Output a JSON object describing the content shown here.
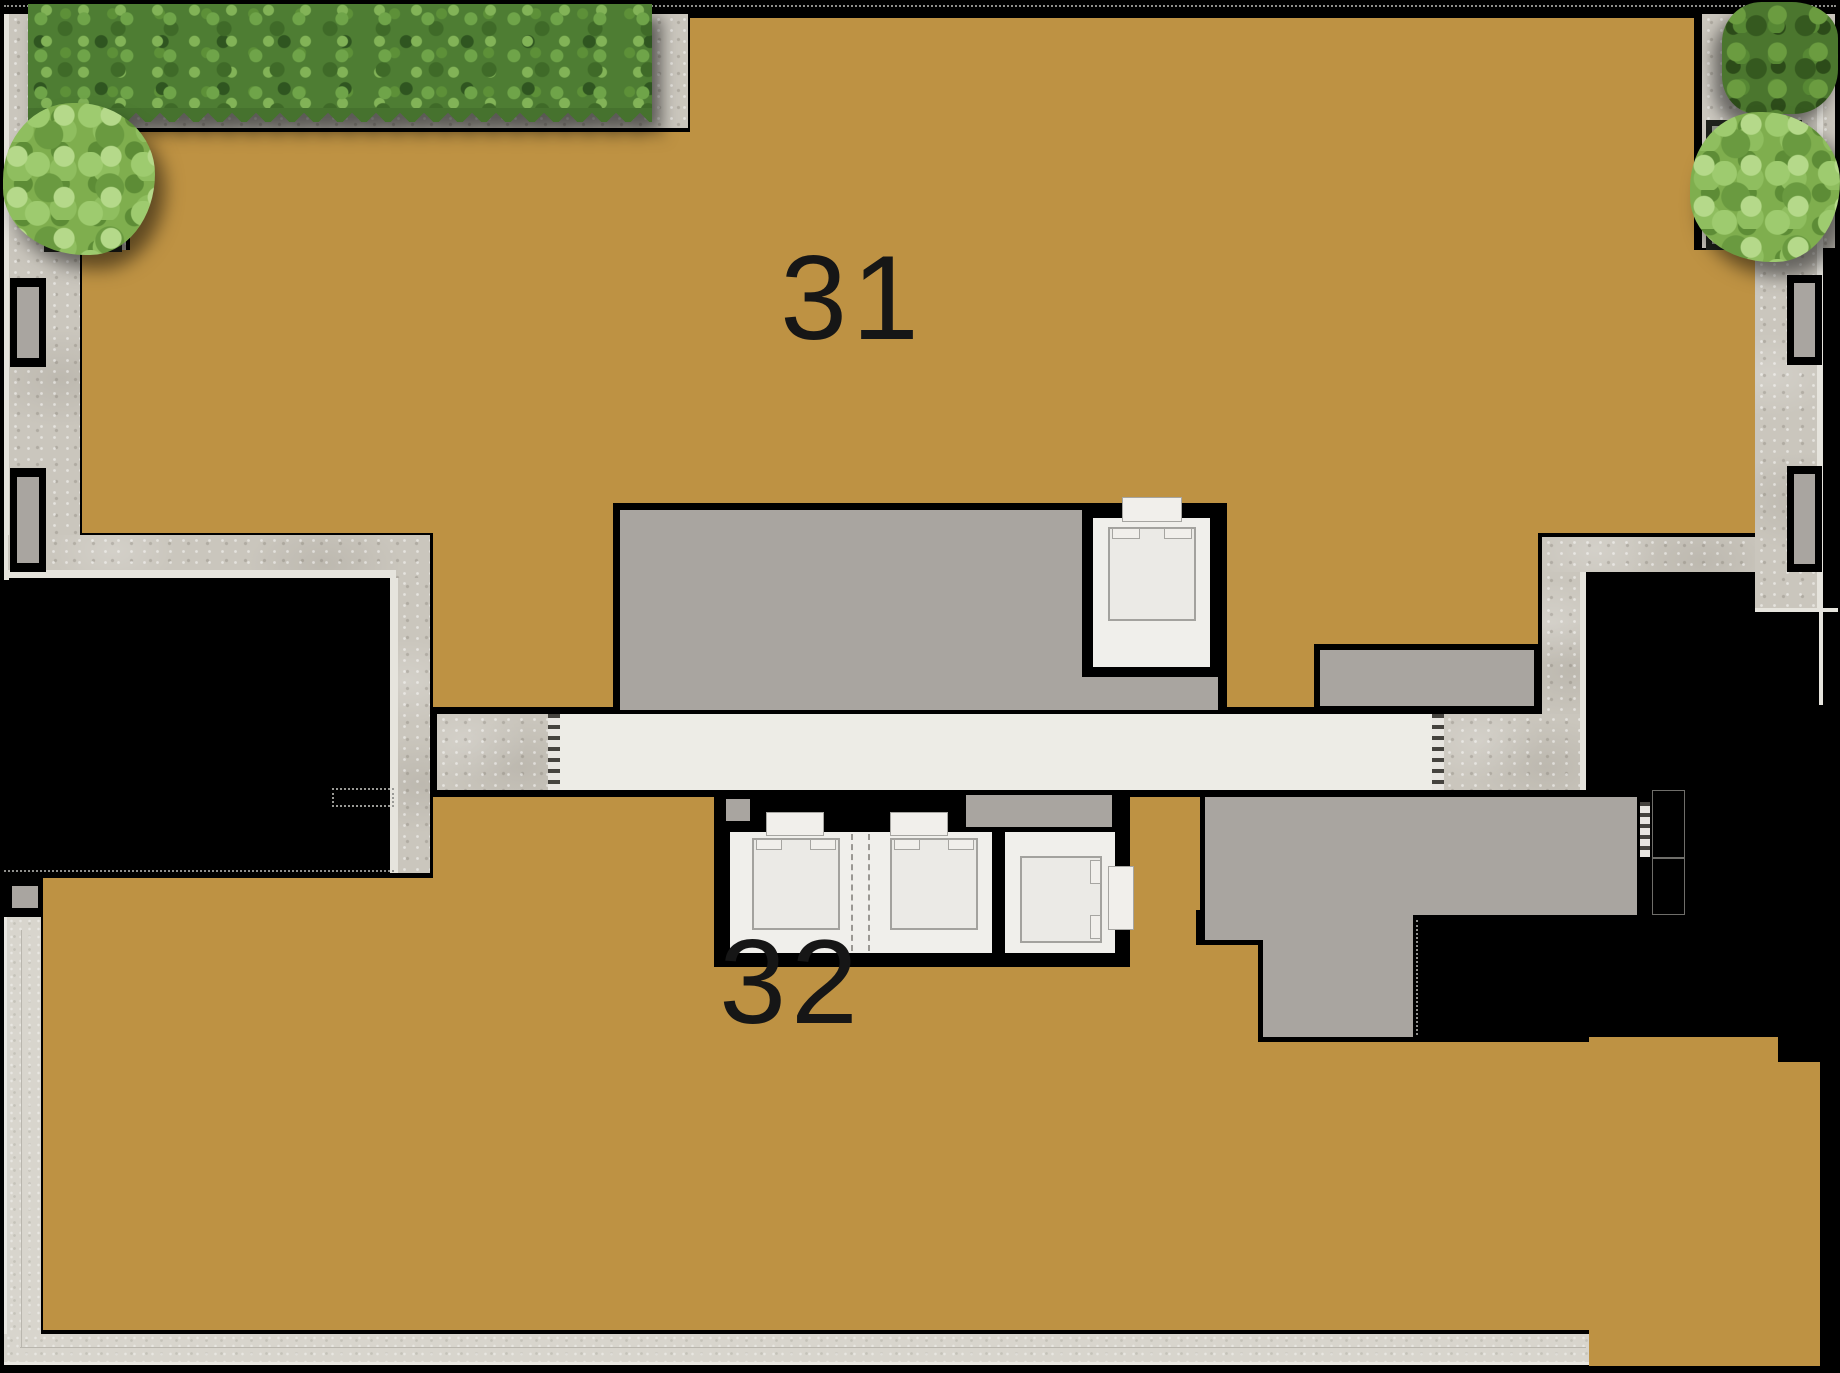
{
  "plan": {
    "type": "residential-floor-plan",
    "units": [
      {
        "name": "unit-31",
        "label": "31"
      },
      {
        "name": "unit-32",
        "label": "32"
      }
    ]
  },
  "colors": {
    "background": "#000000",
    "unit_fill": "#be9243",
    "core_gray": "#a9a5a0",
    "corridor": "#edece6",
    "concrete": "#cac6bd",
    "walkway": "#d8d5cd",
    "elevator_white": "#f0efeb",
    "hedge_green": "#4e7d33",
    "tree_green": "#7fae4e"
  },
  "landscaping_icons": [
    "hedge-icon",
    "tree-icon",
    "tree-icon",
    "shrub-icon"
  ],
  "core_elements": [
    "elevator",
    "elevator",
    "elevator",
    "elevator",
    "stairwell",
    "service-core",
    "corridor"
  ]
}
